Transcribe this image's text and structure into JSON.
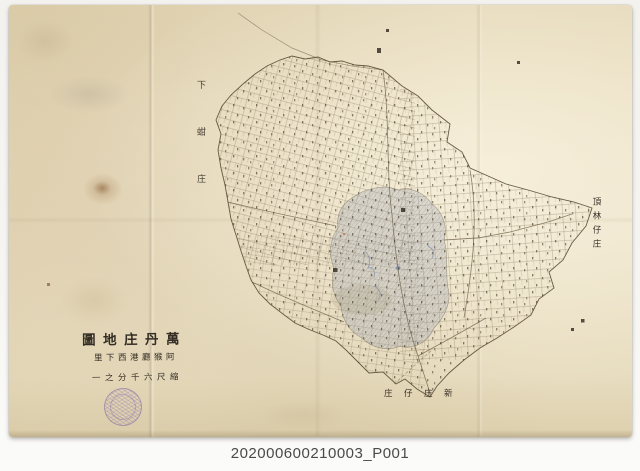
{
  "document": {
    "type": "scanned archival cadastral map",
    "catalog_number": "202000600210003_P001"
  },
  "title_block": {
    "direction": "right-to-left handwriting",
    "line1_display": "圖地庄丹萬",
    "line2_display": "里下西港廳猴阿",
    "line3_display": "一之分千六尺縮"
  },
  "place_labels": {
    "west_vertical": "下蚶庄",
    "northeast_vertical": "頂林仔庄",
    "south_horizontal_display": "庄仔庄新"
  },
  "seal": {
    "shape": "round-stamp",
    "legibility": "illegible",
    "color": "#7a5fa8"
  },
  "colors": {
    "paper": "#e8ddc2",
    "ink": "#55442c",
    "settlement_wash": "#97a0b4",
    "caption_text": "#4a4a48",
    "backdrop": "#f5f4f1"
  }
}
